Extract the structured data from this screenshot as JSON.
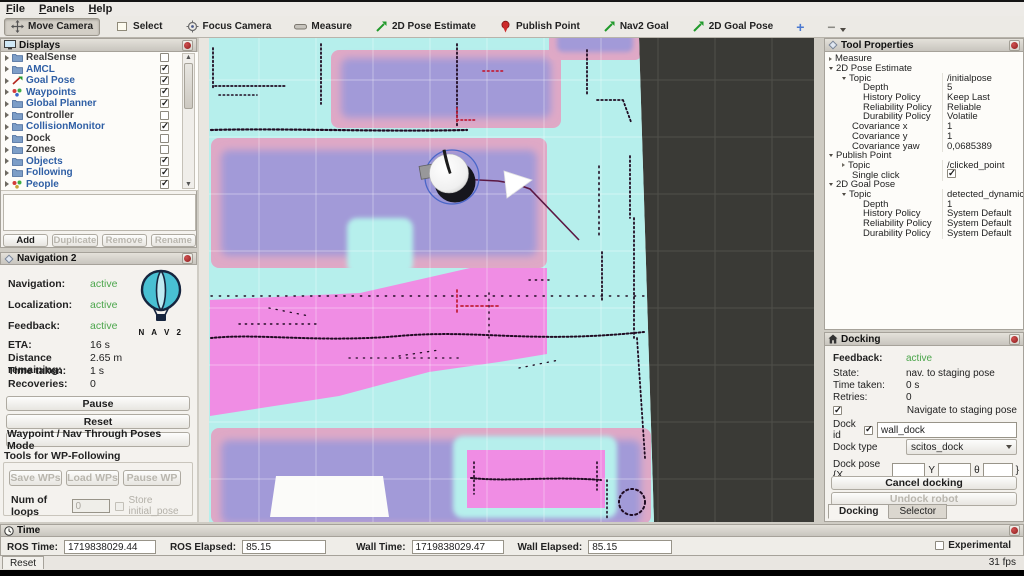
{
  "menu": {
    "items": [
      "File",
      "Panels",
      "Help"
    ]
  },
  "toolbar": {
    "tools": [
      {
        "label": "Move Camera",
        "icon": "move-camera-icon",
        "active": true
      },
      {
        "label": "Select",
        "icon": "select-icon",
        "active": false
      },
      {
        "label": "Focus Camera",
        "icon": "focus-camera-icon",
        "active": false
      },
      {
        "label": "Measure",
        "icon": "measure-icon",
        "active": false
      },
      {
        "label": "2D Pose Estimate",
        "icon": "green-arrow-icon",
        "active": false
      },
      {
        "label": "Publish Point",
        "icon": "map-pin-icon",
        "active": false
      },
      {
        "label": "Nav2 Goal",
        "icon": "green-arrow-icon",
        "active": false
      },
      {
        "label": "2D Goal Pose",
        "icon": "green-arrow-icon",
        "active": false
      }
    ],
    "add_label": "+",
    "remove_label": "−"
  },
  "displays_panel": {
    "title": "Displays",
    "items": [
      {
        "name": "RealSense",
        "checked": false,
        "icon": "folder"
      },
      {
        "name": "AMCL",
        "checked": true,
        "icon": "folder"
      },
      {
        "name": "Goal Pose",
        "checked": true,
        "icon": "goal-arrow"
      },
      {
        "name": "Waypoints",
        "checked": true,
        "icon": "waypoints-dots"
      },
      {
        "name": "Global Planner",
        "checked": true,
        "icon": "folder"
      },
      {
        "name": "Controller",
        "checked": false,
        "icon": "folder"
      },
      {
        "name": "CollisionMonitor",
        "checked": true,
        "icon": "folder"
      },
      {
        "name": "Dock",
        "checked": false,
        "icon": "folder"
      },
      {
        "name": "Zones",
        "checked": false,
        "icon": "folder"
      },
      {
        "name": "Objects",
        "checked": true,
        "icon": "folder"
      },
      {
        "name": "Following",
        "checked": true,
        "icon": "folder"
      },
      {
        "name": "People",
        "checked": true,
        "icon": "people-dots"
      }
    ],
    "buttons": {
      "add": "Add",
      "duplicate": "Duplicate",
      "remove": "Remove",
      "rename": "Rename"
    }
  },
  "nav2_panel": {
    "title": "Navigation 2",
    "statuses": [
      {
        "label": "Navigation:",
        "value": "active"
      },
      {
        "label": "Localization:",
        "value": "active"
      },
      {
        "label": "Feedback:",
        "value": "active"
      }
    ],
    "logo_text": "N A V 2",
    "stats": [
      {
        "label": "ETA:",
        "value": "16 s"
      },
      {
        "label": "Distance remaining:",
        "value": "2.65 m"
      },
      {
        "label": "Time taken:",
        "value": "1 s"
      },
      {
        "label": "Recoveries:",
        "value": "0"
      }
    ],
    "buttons": {
      "pause": "Pause",
      "reset": "Reset",
      "waypoint_mode": "Waypoint / Nav Through Poses Mode"
    },
    "wp_tools": {
      "heading": "Tools for WP-Following",
      "save": "Save WPs",
      "load": "Load WPs",
      "pause_wp": "Pause WP",
      "num_loops_label": "Num of loops",
      "num_loops_value": "0",
      "store_initial_pose": "Store initial_pose"
    }
  },
  "tool_properties": {
    "title": "Tool Properties",
    "rows": [
      {
        "label": "Measure",
        "value": ""
      },
      {
        "label": "2D Pose Estimate",
        "value": ""
      },
      {
        "label": "Topic",
        "value": "/initialpose"
      },
      {
        "label": "Depth",
        "value": "5"
      },
      {
        "label": "History Policy",
        "value": "Keep Last"
      },
      {
        "label": "Reliability Policy",
        "value": "Reliable"
      },
      {
        "label": "Durability Policy",
        "value": "Volatile"
      },
      {
        "label": "Covariance x",
        "value": "1"
      },
      {
        "label": "Covariance y",
        "value": "1"
      },
      {
        "label": "Covariance yaw",
        "value": "0,0685389"
      },
      {
        "label": "Publish Point",
        "value": ""
      },
      {
        "label": "Topic",
        "value": "/clicked_point"
      },
      {
        "label": "Single click",
        "value": "true",
        "type": "checkbox"
      },
      {
        "label": "2D Goal Pose",
        "value": ""
      },
      {
        "label": "Topic",
        "value": "detected_dynamic..."
      },
      {
        "label": "Depth",
        "value": "1"
      },
      {
        "label": "History Policy",
        "value": "System Default"
      },
      {
        "label": "Reliability Policy",
        "value": "System Default"
      },
      {
        "label": "Durability Policy",
        "value": "System Default"
      }
    ]
  },
  "docking_panel": {
    "title": "Docking",
    "feedback_label": "Feedback:",
    "feedback_value": "active",
    "rows": [
      {
        "label": "State:",
        "value": "nav. to staging pose"
      },
      {
        "label": "Time taken:",
        "value": "0 s"
      },
      {
        "label": "Retries:",
        "value": "0"
      }
    ],
    "navigate_label": "Navigate to staging pose",
    "dock_id_label": "Dock id",
    "dock_id_value": "wall_dock",
    "dock_type_label": "Dock type",
    "dock_type_value": "scitos_dock",
    "dock_pose_label": "Dock pose {X",
    "y_label": "Y",
    "theta_label": "θ",
    "close_brace": "}",
    "cancel_button": "Cancel docking",
    "undock_button": "Undock robot",
    "tabs": [
      "Docking",
      "Selector"
    ]
  },
  "time_panel": {
    "title": "Time",
    "fields": [
      {
        "label": "ROS Time:",
        "value": "1719838029.44"
      },
      {
        "label": "ROS Elapsed:",
        "value": "85.15"
      },
      {
        "label": "Wall Time:",
        "value": "1719838029.47"
      },
      {
        "label": "Wall Elapsed:",
        "value": "85.15"
      }
    ],
    "experimental_label": "Experimental",
    "reset_button": "Reset",
    "fps": "31 fps"
  },
  "map_colors": {
    "unknown_space": "#3a3a36",
    "inflation_cyan": "#b6efec",
    "costmap_purple": "#a29ad8",
    "costmap_pink_fringe": "#dfa9c6",
    "lethal_magenta": "#f08de4",
    "laser_scan": "#200b22",
    "dynamic_scan_red": "#c2203a",
    "path": "#5b1843",
    "status_green": "#4ca64c"
  }
}
